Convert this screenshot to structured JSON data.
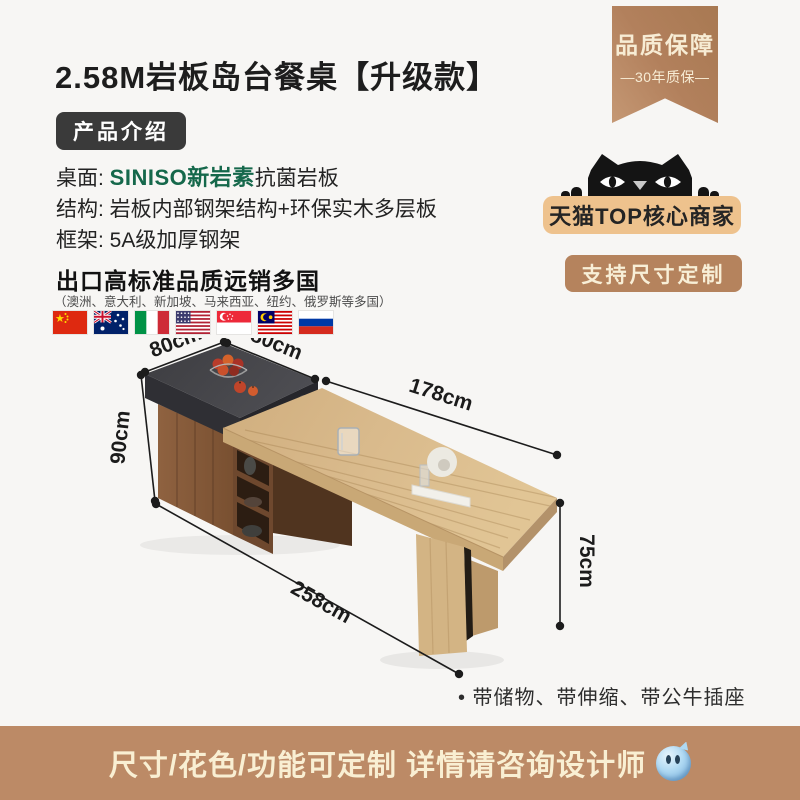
{
  "page": {
    "background": "#f7f6f4"
  },
  "title": "2.58M岩板岛台餐桌【升级款】",
  "intro_badge": "产品介绍",
  "specs": [
    {
      "label": "桌面: ",
      "brand": "SINISO新岩素",
      "text": "抗菌岩板"
    },
    {
      "label": "结构: ",
      "text": "岩板内部钢架结构+环保实木多层板"
    },
    {
      "label": "框架: ",
      "text": "5A级加厚钢架"
    }
  ],
  "export_info": {
    "heading": "出口高标准品质远销多国",
    "countries": "（澳洲、意大利、新加坡、马来西亚、纽约、俄罗斯等多国）",
    "flags": [
      "china",
      "australia",
      "italy",
      "usa",
      "singapore",
      "malaysia",
      "russia"
    ]
  },
  "quality_ribbon": {
    "line1": "品质保障",
    "line2": "—30年质保—"
  },
  "tmall": {
    "badge": "天猫TOP核心商家",
    "button": "支持尺寸定制"
  },
  "dimensions": {
    "island_width": "80cm",
    "island_depth": "80cm",
    "table_length": "178cm",
    "island_height": "90cm",
    "total_length": "258cm",
    "table_height": "75cm"
  },
  "features": "• 带储物、带伸缩、带公牛插座",
  "footer": {
    "text": "尺寸/花色/功能可定制 详情请咨询设计师"
  },
  "colors": {
    "accent_brown": "#b5835d",
    "badge_tan": "#eec28d",
    "brand_green": "#15684b",
    "footer_brown": "#bc8a66",
    "ribbon_brown": "#b2805c"
  }
}
